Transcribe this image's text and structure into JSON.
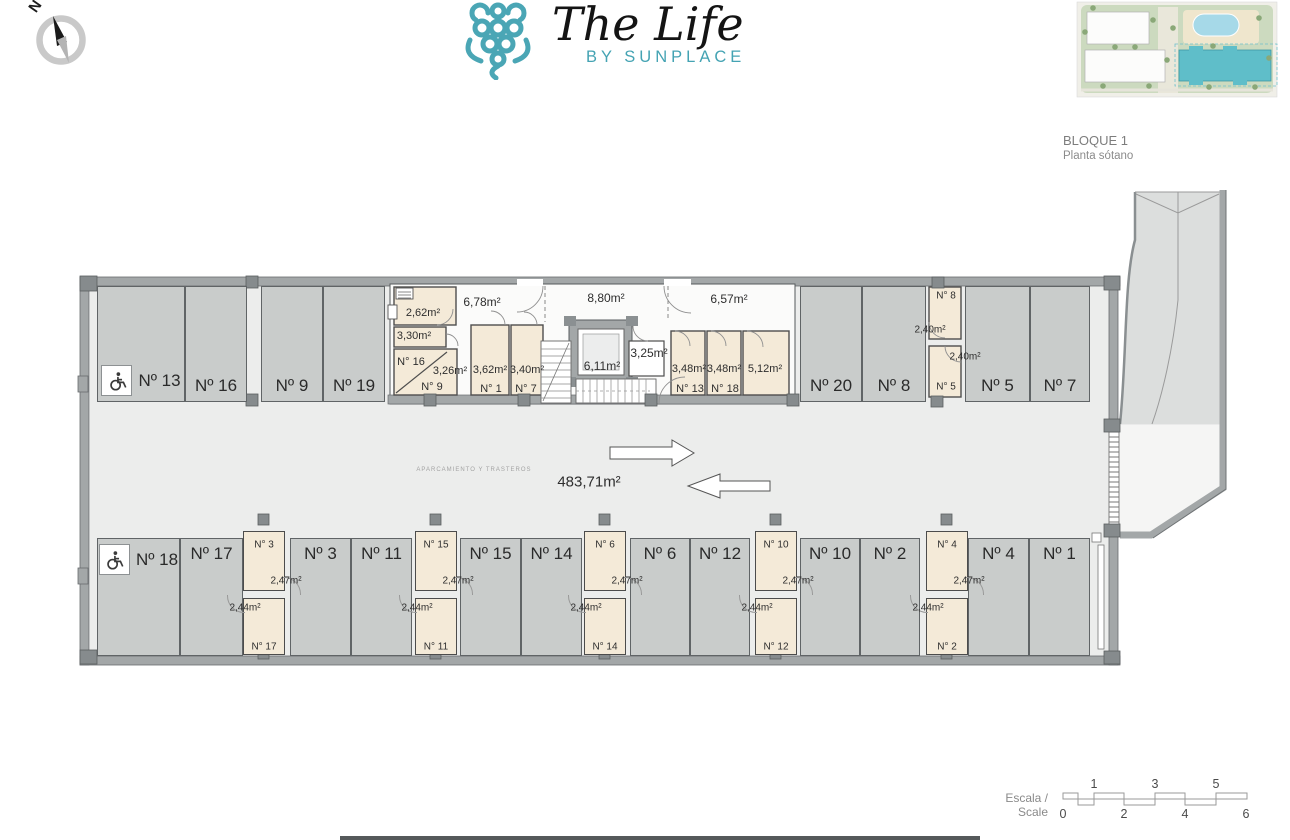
{
  "header": {
    "logo_title": "The Life",
    "logo_subtitle": "BY SUNPLACE",
    "compass_label": "N",
    "block_title": "BLOQUE 1",
    "block_subtitle": "Planta sótano"
  },
  "plan": {
    "area_total": "483,71m²",
    "aisle_note": "APARCAMIENTO Y TRASTEROS",
    "parking_spaces": [
      {
        "label": "Nº 13",
        "row": "top",
        "disabled": true,
        "x": 97,
        "y": 286,
        "w": 88,
        "h": 116
      },
      {
        "label": "Nº 16",
        "row": "top",
        "x": 185,
        "y": 286,
        "w": 62,
        "h": 116
      },
      {
        "label": "Nº 9",
        "row": "top",
        "x": 261,
        "y": 286,
        "w": 62,
        "h": 116
      },
      {
        "label": "Nº 19",
        "row": "top",
        "x": 323,
        "y": 286,
        "w": 62,
        "h": 116
      },
      {
        "label": "Nº 20",
        "row": "top",
        "x": 800,
        "y": 286,
        "w": 62,
        "h": 116
      },
      {
        "label": "Nº 8",
        "row": "top",
        "x": 862,
        "y": 286,
        "w": 64,
        "h": 116
      },
      {
        "label": "Nº 5",
        "row": "top",
        "x": 965,
        "y": 286,
        "w": 65,
        "h": 116
      },
      {
        "label": "Nº 7",
        "row": "top",
        "x": 1030,
        "y": 286,
        "w": 60,
        "h": 116
      },
      {
        "label": "Nº 18",
        "row": "bottom",
        "disabled": true,
        "x": 97,
        "y": 538,
        "w": 83,
        "h": 118
      },
      {
        "label": "Nº 17",
        "row": "bottom",
        "x": 180,
        "y": 538,
        "w": 63,
        "h": 118
      },
      {
        "label": "Nº 3",
        "row": "bottom",
        "x": 290,
        "y": 538,
        "w": 61,
        "h": 118
      },
      {
        "label": "Nº 11",
        "row": "bottom",
        "x": 351,
        "y": 538,
        "w": 61,
        "h": 118
      },
      {
        "label": "Nº 15",
        "row": "bottom",
        "x": 460,
        "y": 538,
        "w": 61,
        "h": 118
      },
      {
        "label": "Nº 14",
        "row": "bottom",
        "x": 521,
        "y": 538,
        "w": 61,
        "h": 118
      },
      {
        "label": "Nº 6",
        "row": "bottom",
        "x": 630,
        "y": 538,
        "w": 60,
        "h": 118
      },
      {
        "label": "Nº 12",
        "row": "bottom",
        "x": 690,
        "y": 538,
        "w": 60,
        "h": 118
      },
      {
        "label": "Nº 10",
        "row": "bottom",
        "x": 800,
        "y": 538,
        "w": 60,
        "h": 118
      },
      {
        "label": "Nº 2",
        "row": "bottom",
        "x": 860,
        "y": 538,
        "w": 60,
        "h": 118
      },
      {
        "label": "Nº 4",
        "row": "bottom",
        "x": 968,
        "y": 538,
        "w": 61,
        "h": 118
      },
      {
        "label": "Nº 1",
        "row": "bottom",
        "x": 1029,
        "y": 538,
        "w": 61,
        "h": 118
      }
    ],
    "storage_columns": [
      {
        "cx": 264,
        "num_top": "N° 3",
        "area_top": "2,47m²",
        "area_bottom": "2,44m²",
        "num_bottom": "N° 17"
      },
      {
        "cx": 436,
        "num_top": "N° 15",
        "area_top": "2,47m²",
        "area_bottom": "2,44m²",
        "num_bottom": "N° 11"
      },
      {
        "cx": 605,
        "num_top": "N° 6",
        "area_top": "2,47m²",
        "area_bottom": "2,44m²",
        "num_bottom": "N° 14"
      },
      {
        "cx": 776,
        "num_top": "N° 10",
        "area_top": "2,47m²",
        "area_bottom": "2,44m²",
        "num_bottom": "N° 12"
      },
      {
        "cx": 947,
        "num_top": "N° 4",
        "area_top": "2,47m²",
        "area_bottom": "2,44m²",
        "num_bottom": "N° 2"
      }
    ],
    "room_labels": [
      {
        "t": "2,62m²",
        "x": 423,
        "y": 313,
        "s": 11
      },
      {
        "t": "3,30m²",
        "x": 414,
        "y": 336,
        "s": 11
      },
      {
        "t": "N° 16",
        "x": 411,
        "y": 362,
        "s": 11
      },
      {
        "t": "3,26m²",
        "x": 450,
        "y": 371,
        "s": 11
      },
      {
        "t": "N° 9",
        "x": 432,
        "y": 387,
        "s": 11
      },
      {
        "t": "6,78m²",
        "x": 482,
        "y": 302,
        "s": 12
      },
      {
        "t": "3,62m²",
        "x": 490,
        "y": 370,
        "s": 11
      },
      {
        "t": "N° 1",
        "x": 491,
        "y": 389,
        "s": 11
      },
      {
        "t": "3,40m²",
        "x": 527,
        "y": 370,
        "s": 11
      },
      {
        "t": "N° 7",
        "x": 526,
        "y": 389,
        "s": 11
      },
      {
        "t": "8,80m²",
        "x": 606,
        "y": 298,
        "s": 12
      },
      {
        "t": "6,11m²",
        "x": 602,
        "y": 366,
        "s": 12
      },
      {
        "t": "3,25m²",
        "x": 649,
        "y": 353,
        "s": 12
      },
      {
        "t": "6,57m²",
        "x": 729,
        "y": 299,
        "s": 12
      },
      {
        "t": "3,48m²",
        "x": 689,
        "y": 369,
        "s": 11
      },
      {
        "t": "N° 13",
        "x": 690,
        "y": 389,
        "s": 11
      },
      {
        "t": "3,48m²",
        "x": 724,
        "y": 369,
        "s": 11
      },
      {
        "t": "N° 18",
        "x": 725,
        "y": 389,
        "s": 11
      },
      {
        "t": "5,12m²",
        "x": 765,
        "y": 369,
        "s": 11
      },
      {
        "t": "N° 8",
        "x": 946,
        "y": 296,
        "s": 10
      },
      {
        "t": "2,40m²",
        "x": 930,
        "y": 330,
        "s": 10
      },
      {
        "t": "2,40m²",
        "x": 965,
        "y": 357,
        "s": 10
      },
      {
        "t": "N° 5",
        "x": 946,
        "y": 387,
        "s": 10
      }
    ]
  },
  "scale_bar": {
    "label": "Escala / Scale",
    "top_ticks": [
      "1",
      "3",
      "5"
    ],
    "bottom_ticks": [
      "0",
      "2",
      "4",
      "6"
    ]
  }
}
